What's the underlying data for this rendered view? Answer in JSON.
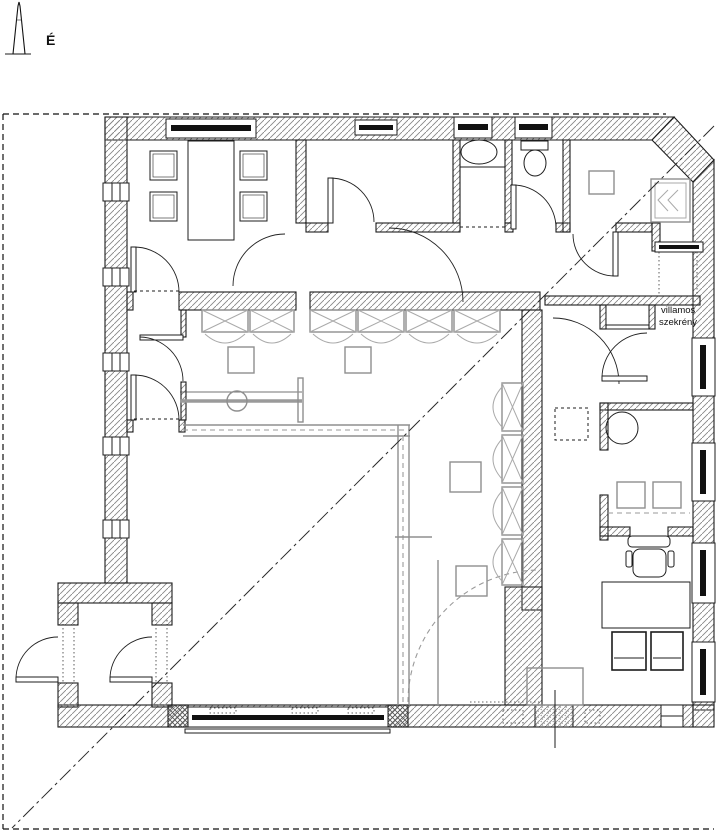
{
  "drawing": {
    "type": "architectural-floor-plan",
    "north_label": "É",
    "annotations": {
      "electrical_cabinet_line1": "villamos",
      "electrical_cabinet_line2": "szekrény"
    },
    "colors": {
      "ink": "#1c1c1c",
      "hatch": "#878787",
      "glazing": "#111111",
      "furniture_gray": "#8f8f8f",
      "partition_gray": "#9a9a9a",
      "background": "#ffffff"
    },
    "elements": {
      "rooms": [
        "meeting-room",
        "window-room",
        "washroom",
        "wc",
        "corner-room",
        "wardrobe-room",
        "central-hall",
        "round-table-room",
        "seat-room",
        "office",
        "vestibule"
      ],
      "fixture_counts": {
        "wardrobe-units-horizontal": 6,
        "wardrobe-units-vertical": 4,
        "meeting-chairs": 4,
        "visitor-chairs": 2
      }
    }
  }
}
